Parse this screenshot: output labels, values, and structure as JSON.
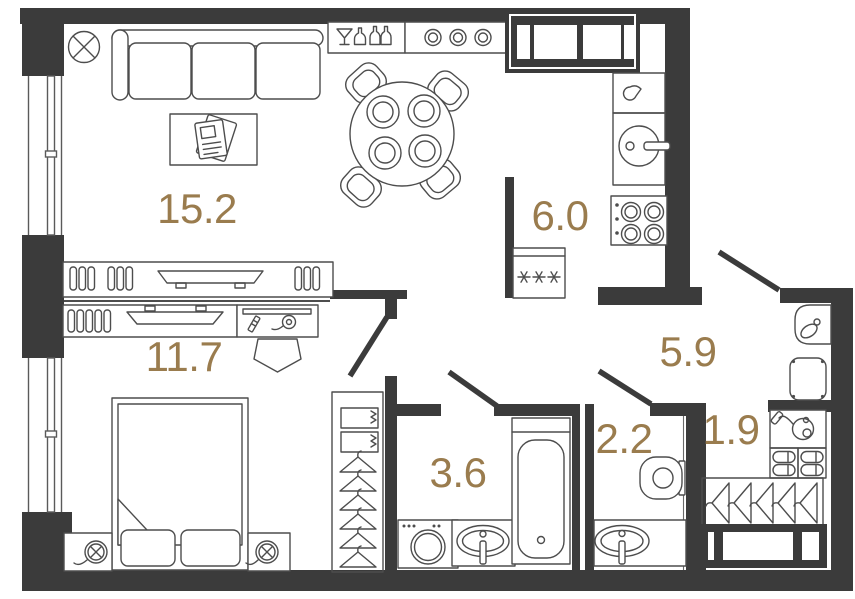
{
  "floorplan": {
    "kind": "apartment-floor-plan",
    "colors": {
      "background": "#ffffff",
      "wall": "#3b3b3b",
      "furniture_outline": "#4d4d4d",
      "area_label": "#9a7c4e"
    },
    "rooms": {
      "living_room": {
        "area_label": "15.2"
      },
      "kitchen": {
        "area_label": "6.0"
      },
      "bedroom": {
        "area_label": "11.7"
      },
      "hallway": {
        "area_label": "5.9"
      },
      "bathroom": {
        "area_label": "3.6"
      },
      "wc": {
        "area_label": "2.2"
      },
      "storage": {
        "area_label": "1.9"
      }
    },
    "icons": [
      "ceiling-light-icon",
      "sofa-icon",
      "coffee-table-magazines-icon",
      "bar-counter-icon",
      "bar-stools-icon",
      "dining-table-icon",
      "dining-chair-icon",
      "built-in-wardrobe-icon",
      "kettle-icon",
      "kitchen-sink-icon",
      "stove-icon",
      "fridge-icon",
      "entry-door-icon",
      "interior-door-icon",
      "shoe-bench-icon",
      "pouf-icon",
      "tv-console-icon",
      "desk-icon",
      "desk-chair-icon",
      "double-bed-icon",
      "nightstand-lamp-icon",
      "wardrobe-shelves-icon",
      "hanger-icon",
      "washing-machine-icon",
      "sink-icon",
      "bathtub-icon",
      "toilet-icon",
      "vacuum-cleaner-icon",
      "slippers-icon",
      "storage-cabinet-icon",
      "window-icon"
    ]
  }
}
